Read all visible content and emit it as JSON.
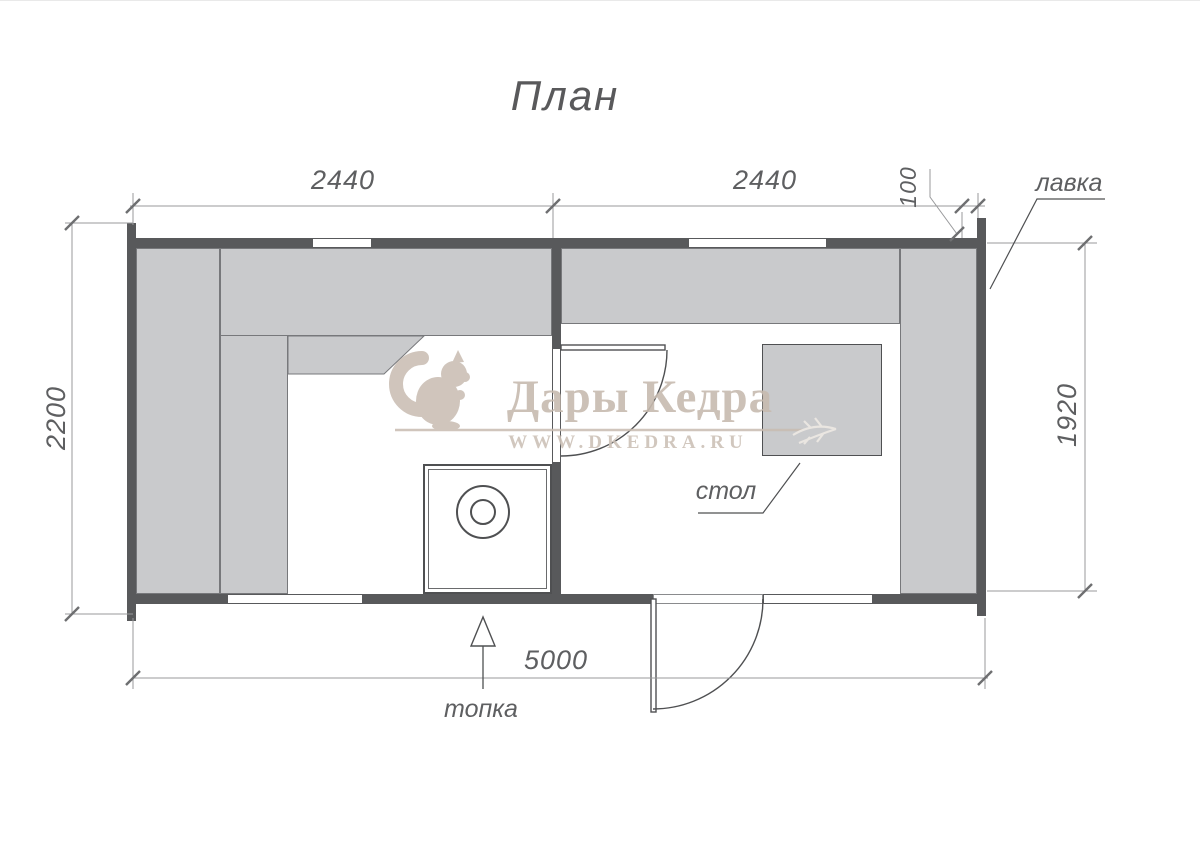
{
  "title": "План",
  "dimensions": {
    "top_left": "2440",
    "top_right": "2440",
    "top_corner": "100",
    "left_total": "2200",
    "right_inner": "1920",
    "bottom_total": "5000"
  },
  "labels": {
    "bench": "лавка",
    "table": "стол",
    "firebox": "топка"
  },
  "watermark": {
    "brand": "Дары Кедра",
    "site": "WWW.DKEDRA.RU"
  },
  "colors": {
    "wall": "#58595b",
    "bench": "#c9cacc",
    "bench_border": "#77787b",
    "line": "#4f5052",
    "dim_line": "#98999b",
    "text": "#5e5f61",
    "watermark": "#c8bcb1",
    "watermark_light": "#f0ebe5",
    "background": "#ffffff"
  }
}
